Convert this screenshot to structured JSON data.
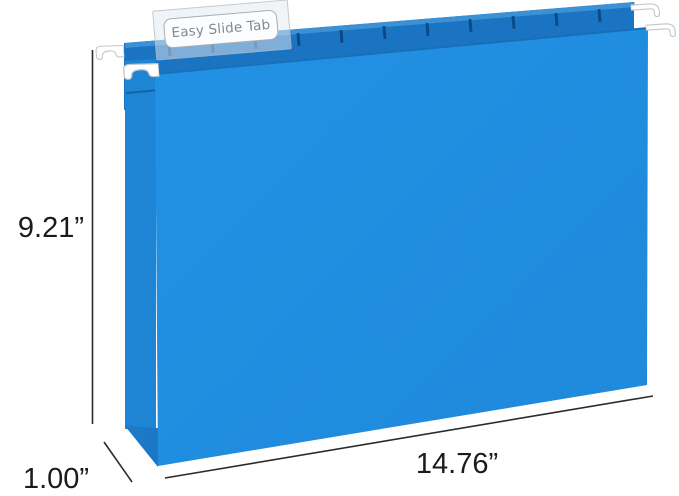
{
  "tab": {
    "label": "Easy Slide Tab"
  },
  "dimensions": {
    "height": "9.21”",
    "depth": "1.00”",
    "width": "14.76”"
  },
  "colors": {
    "background": "#ffffff",
    "folder-front": "#2393e6",
    "folder-front-dark": "#1f88da",
    "folder-back": "#1a74c2",
    "folder-back-highlight": "#3e92d6",
    "folder-gusset": "#1e84d4",
    "folder-gusset-shadow": "#135fa9",
    "folder-wedge": "#0d5ea8",
    "folder-wedge-light": "#2c95e6",
    "slot": "#0a4a88",
    "hook-fill": "#ffffff",
    "hook-stroke": "#c2c8cd",
    "tab-fill": "rgba(228,233,239,0.5)",
    "tab-stroke": "rgba(170,178,186,0.65)",
    "label-bg": "#fcfdfe",
    "label-border": "#a9aeb4",
    "label-text": "#85888c",
    "dim-line": "#2b2b2b",
    "dim-text": "#1b1b1b"
  }
}
